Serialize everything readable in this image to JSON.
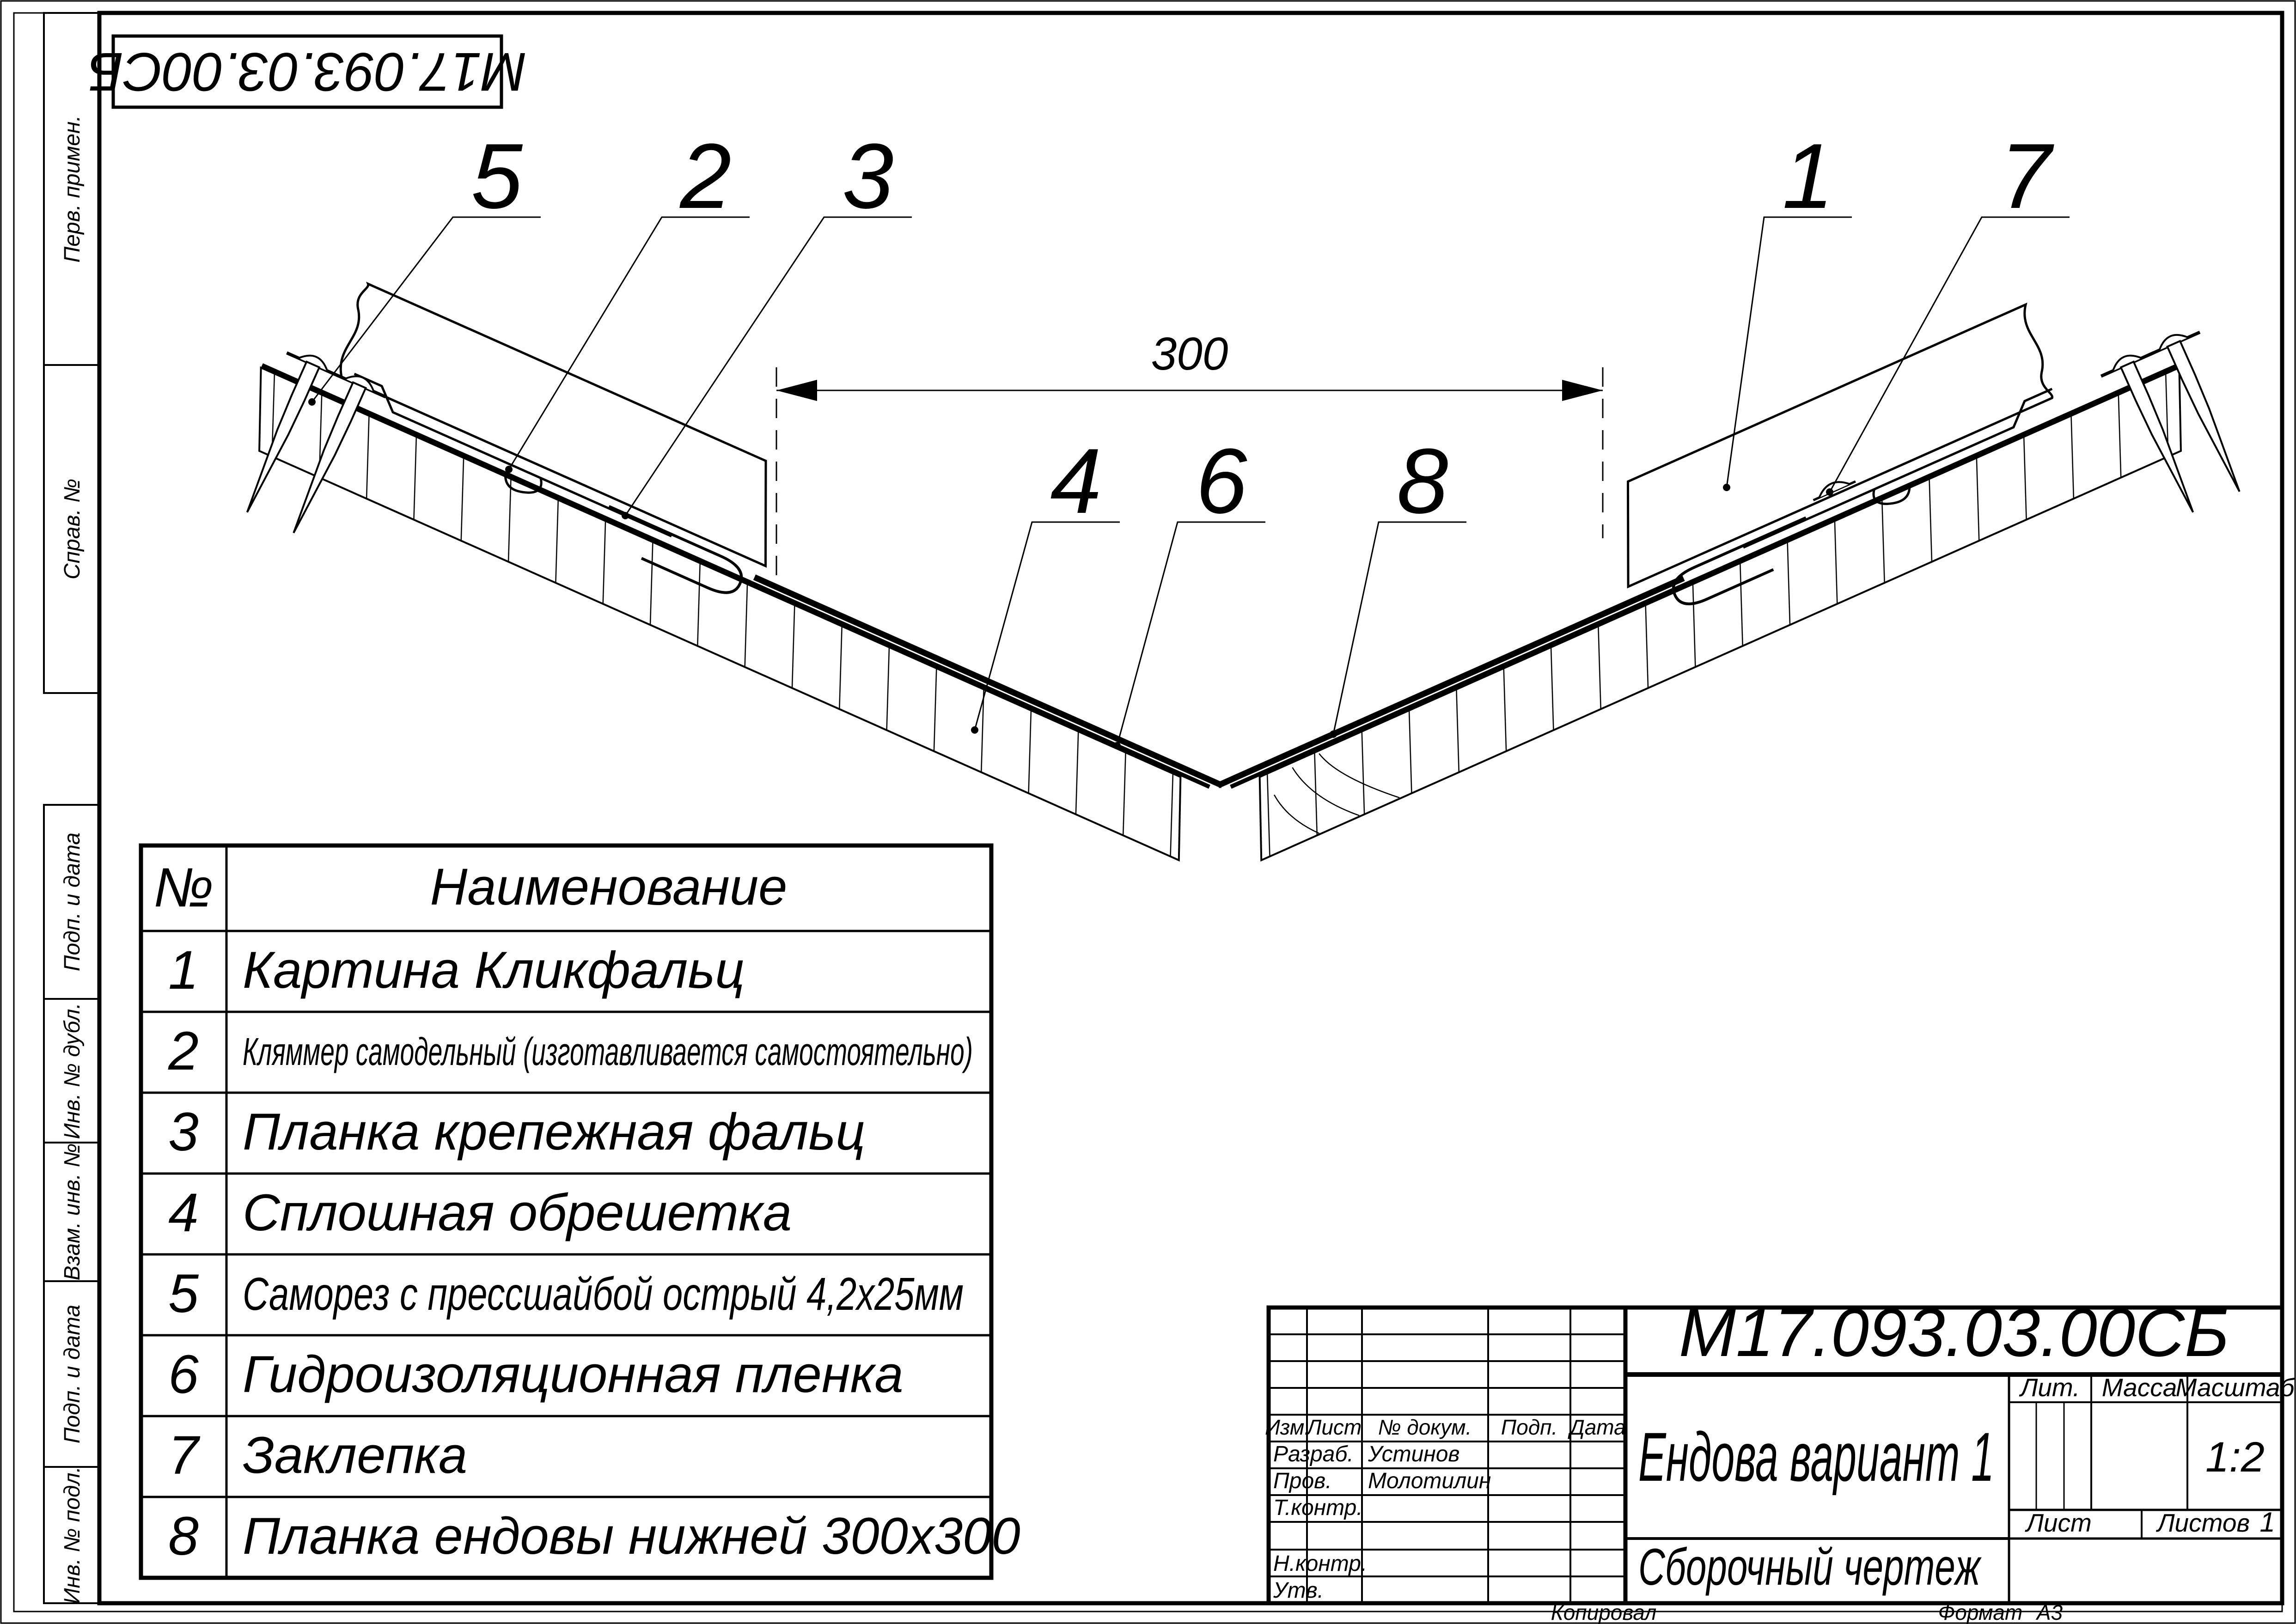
{
  "sheet": {
    "stamp_code": "М17.093.03.00СБ",
    "margin_labels": [
      "Перв. примен.",
      "Справ. №",
      "Подп. и дата",
      "Инв. № дубл.",
      "Взам. инв. №",
      "Подп. и дата",
      "Инв. № подл."
    ],
    "footer": {
      "copied": "Копировал",
      "format_label": "Формат",
      "format_value": "А3"
    }
  },
  "drawing": {
    "dimension_300": "300",
    "callouts": {
      "c1": "1",
      "c2": "2",
      "c3": "3",
      "c4": "4",
      "c5": "5",
      "c6": "6",
      "c7": "7",
      "c8": "8"
    }
  },
  "parts_table": {
    "col_num": "№",
    "col_name": "Наименование",
    "rows": [
      {
        "num": "1",
        "name": "Картина Кликфальц"
      },
      {
        "num": "2",
        "name": "Кляммер самодельный (изготавливается самостоятельно)"
      },
      {
        "num": "3",
        "name": "Планка крепежная фальц"
      },
      {
        "num": "4",
        "name": "Сплошная обрешетка"
      },
      {
        "num": "5",
        "name": "Саморез с прессшайбой острый 4,2х25мм"
      },
      {
        "num": "6",
        "name": "Гидроизоляционная пленка"
      },
      {
        "num": "7",
        "name": "Заклепка"
      },
      {
        "num": "8",
        "name": "Планка ендовы нижней 300х300"
      }
    ]
  },
  "title_block": {
    "doc_code": "М17.093.03.00СБ",
    "title": "Ендова вариант 1",
    "doc_type": "Сборочный чертеж",
    "cols": {
      "izm": "Изм.",
      "list": "Лист",
      "doc": "№ докум.",
      "podp": "Подп.",
      "data": "Дата"
    },
    "roles": {
      "razrab": "Разраб.",
      "prov": "Пров.",
      "tkontr": "Т.контр.",
      "nkontr": "Н.контр.",
      "utv": "Утв."
    },
    "people": {
      "razrab": "Устинов",
      "prov": "Молотилин"
    },
    "lit_label": "Лит.",
    "massa_label": "Масса",
    "masshtab_label": "Масштаб",
    "scale": "1:2",
    "list_label": "Лист",
    "listov_label": "Листов",
    "listov_value": "1"
  }
}
